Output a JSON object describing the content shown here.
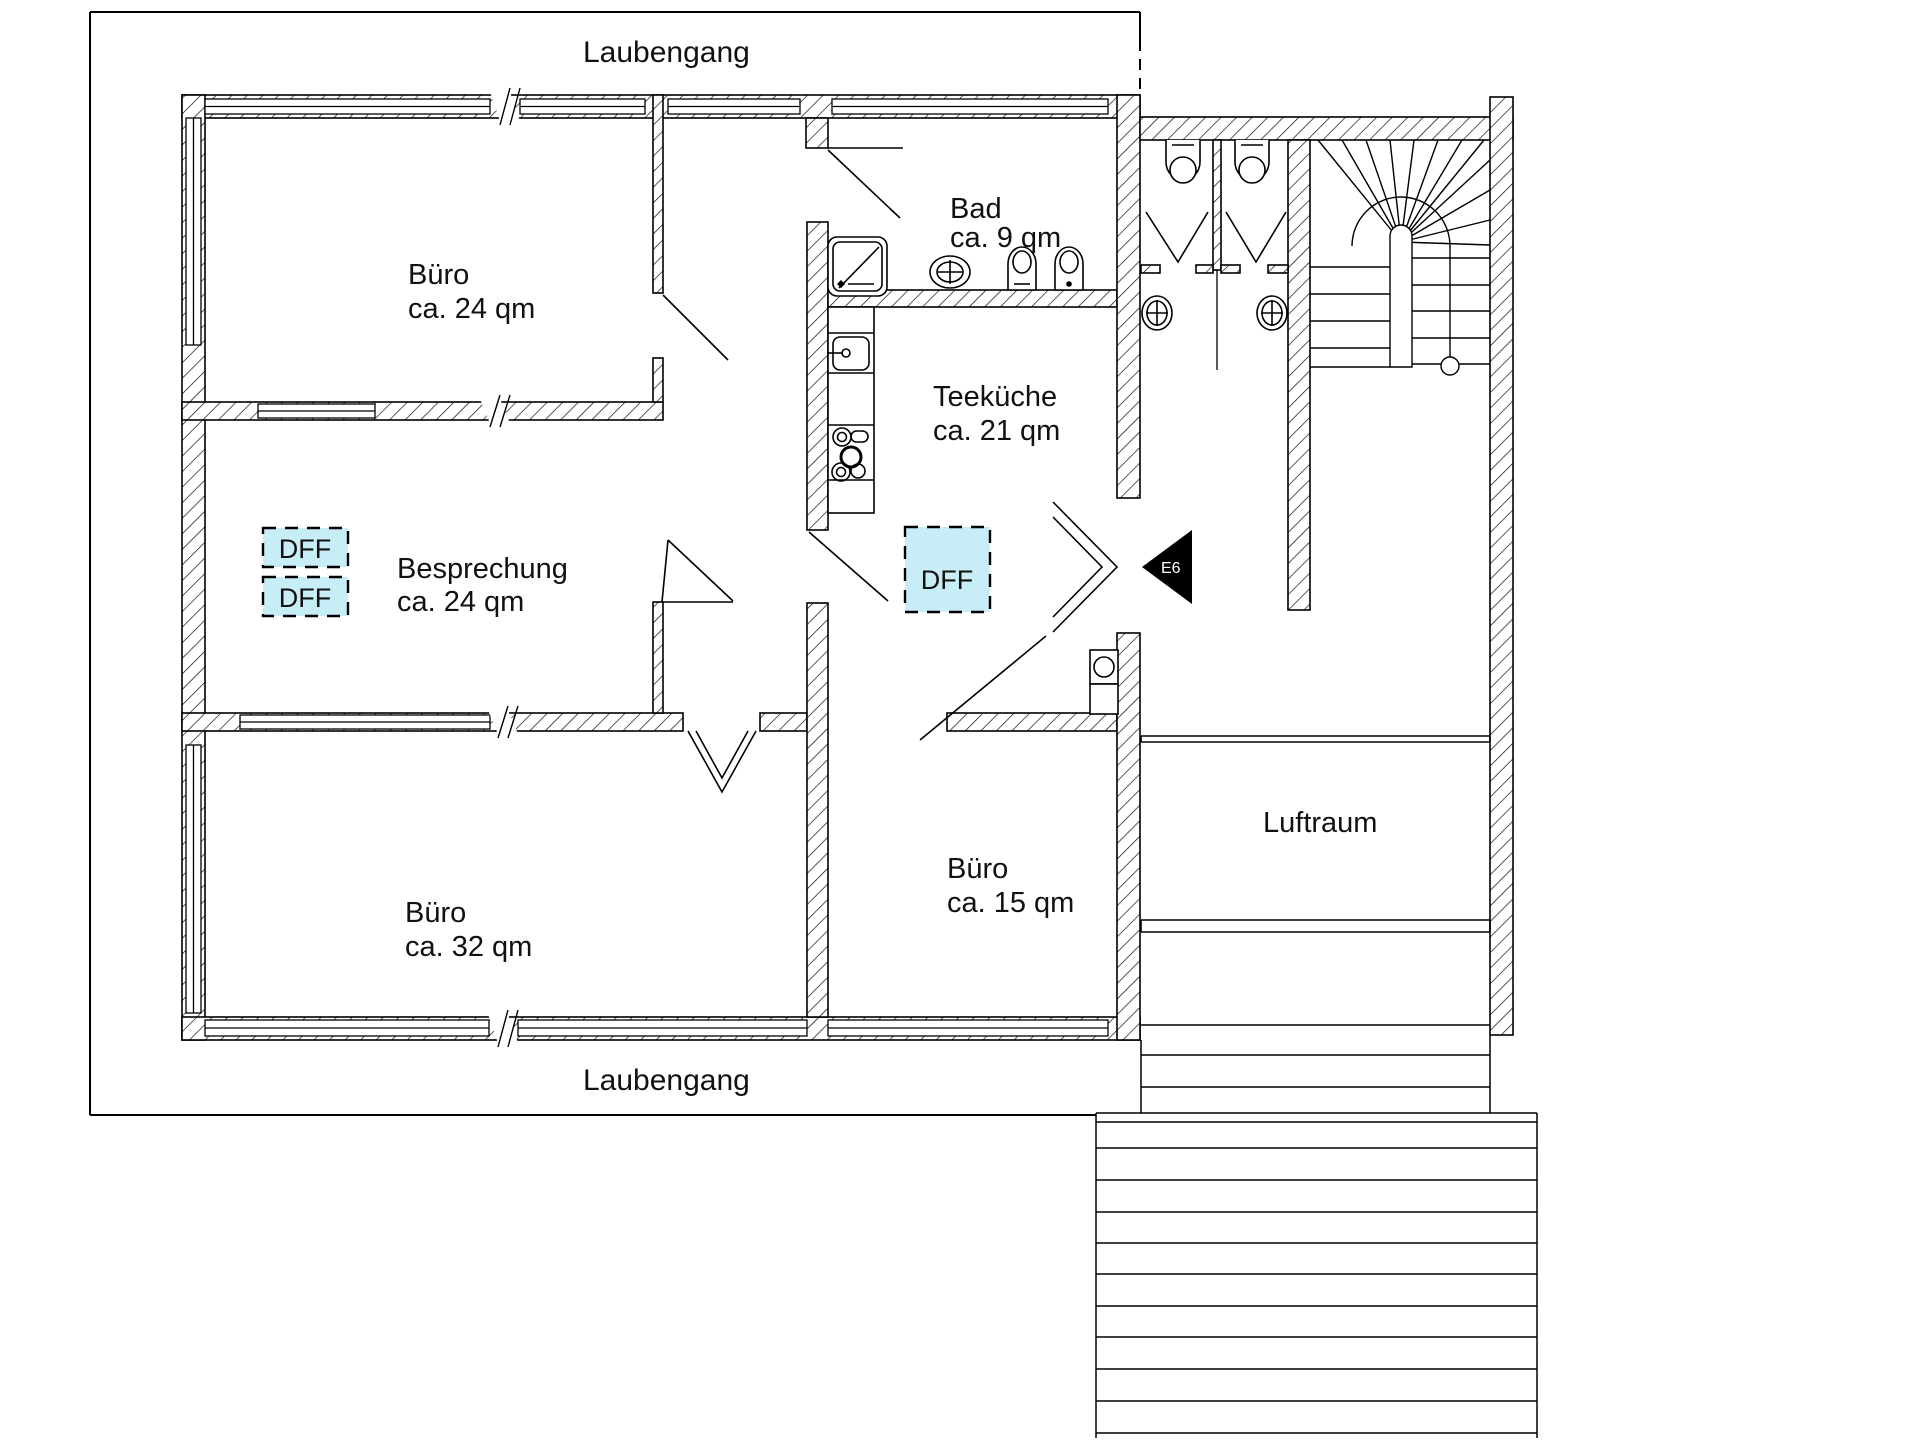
{
  "drawing": {
    "type": "floor-plan",
    "language": "de"
  },
  "labels": {
    "laubengang_top": "Laubengang",
    "laubengang_bottom": "Laubengang"
  },
  "rooms": {
    "buero24": {
      "name": "Büro",
      "area": "ca. 24 qm"
    },
    "besprechung": {
      "name": "Besprechung",
      "area": "ca. 24 qm"
    },
    "buero32": {
      "name": "Büro",
      "area": "ca. 32 qm"
    },
    "buero15": {
      "name": "Büro",
      "area": "ca. 15 qm"
    },
    "teekueche": {
      "name": "Teeküche",
      "area": "ca. 21 qm"
    },
    "bad": {
      "name": "Bad",
      "area": "ca. 9 qm"
    },
    "luftraum": {
      "name": "Luftraum"
    }
  },
  "markers": {
    "dff_label": "DFF",
    "exit_label": "E6"
  },
  "colors": {
    "paper": "#ffffff",
    "line": "#000000",
    "dff_fill": "#c7eef7"
  }
}
